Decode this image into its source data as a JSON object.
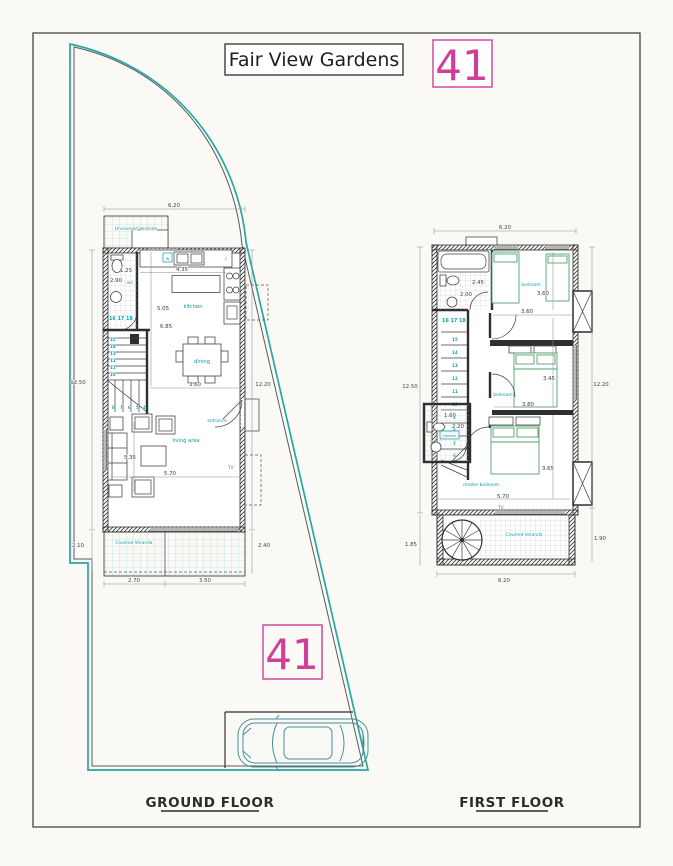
{
  "page": {
    "title": "Fair View Gardens",
    "plot_number_top": "41",
    "plot_number_site": "41"
  },
  "colors": {
    "boundary_teal": "#25a8a5",
    "label_teal": "#12999e",
    "plot_pink": "#cf3f97",
    "drawing_ink": "#2f2f2f",
    "bed_green": "#53a06a"
  },
  "ground_floor": {
    "caption": "GROUND FLOOR",
    "labels": {
      "uncovered_veranda": "Uncovered Veranda",
      "wc": "wc",
      "washer": "w",
      "fridge": "f",
      "kitchen": "kitchen",
      "dining": "dining",
      "living_area": "living area",
      "entrance": "entrance",
      "tv": "TV",
      "covered_veranda": "Covered Veranda",
      "stairs_top": "16 17 18"
    },
    "stair_numbers": [
      "15",
      "14",
      "13",
      "12",
      "11",
      "10"
    ],
    "stair_numbers_low": [
      "8",
      "7",
      "6",
      "5",
      "4"
    ],
    "dims": {
      "top_width": "6.20",
      "wc_width": "1.25",
      "wc_depth": "2.90",
      "kitchen_width": "4.35",
      "hall_depth": "5.05",
      "interior_depth": "6.85",
      "stair_width": "3.60",
      "living_depth": "5.35",
      "living_width": "5.70",
      "left_height": "12.50",
      "left_offset": "2.10",
      "right_height": "12.20",
      "right_offset": "2.40",
      "veranda_w1": "2.70",
      "veranda_w2": "3.50"
    }
  },
  "first_floor": {
    "caption": "FIRST FLOOR",
    "labels": {
      "bedroom_top": "bedroom",
      "bedroom_mid": "bedroom",
      "master_bedroom": "master bedroom",
      "shower": "shower",
      "tv": "TV",
      "covered_veranda": "Covered Veranda",
      "stairs_top": "16 17 18"
    },
    "stair_numbers": [
      "15",
      "14",
      "13",
      "12",
      "11",
      "10",
      "9",
      "8",
      "7",
      "6"
    ],
    "dims": {
      "top_width": "6.20",
      "bath_width": "2.45",
      "bath_width2": "2.00",
      "bedroom_top_depth": "3.60",
      "bedroom_top_width": "3.60",
      "bedroom_mid_depth": "3.45",
      "bedroom_mid_width": "3.80",
      "master_depth": "3.65",
      "master_width": "5.70",
      "shower_dim1": "1.60",
      "shower_dim2": "2.20",
      "left_height": "12.50",
      "left_offset": "1.85",
      "right_height": "12.20",
      "right_offset": "1.90",
      "bottom_width": "6.20"
    }
  }
}
